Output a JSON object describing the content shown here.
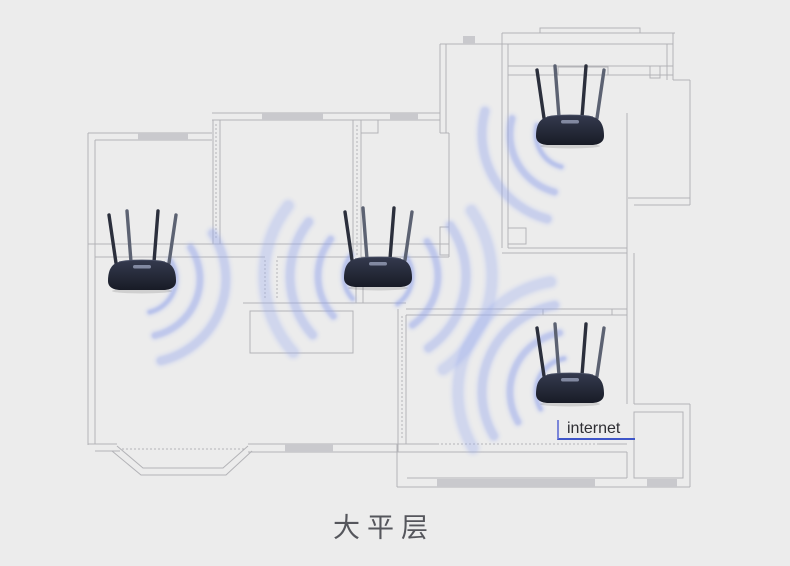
{
  "labels": {
    "internet": "internet",
    "caption": "大平层"
  },
  "colors": {
    "background": "#ececec",
    "wall": "#b3b3b7",
    "window_fill": "#c9c9cd",
    "wifi_wave": "#8c9ee9",
    "wifi_wave_halo": "#bcc6f4",
    "internet_line": "#3e55c8",
    "internet_tick": "#7b86d9",
    "router_body_top": "#343a4e",
    "router_body_bottom": "#181b26",
    "antenna_dark": "#2b2f3c",
    "antenna_light": "#5c6272",
    "caption_text": "#55565c"
  },
  "floorplan": {
    "lines": [
      [
        88,
        133,
        212,
        133
      ],
      [
        95,
        140,
        212,
        140
      ],
      [
        88,
        133,
        88,
        445
      ],
      [
        95,
        140,
        95,
        444
      ],
      [
        213,
        120,
        213,
        244
      ],
      [
        220,
        120,
        220,
        244
      ],
      [
        212,
        113,
        440,
        113
      ],
      [
        212,
        120,
        440,
        120
      ],
      [
        440,
        44,
        440,
        133
      ],
      [
        446,
        44,
        446,
        133
      ],
      [
        440,
        133,
        449,
        133
      ],
      [
        449,
        133,
        449,
        257
      ],
      [
        353,
        120,
        353,
        257
      ],
      [
        361,
        120,
        361,
        257
      ],
      [
        356,
        285,
        356,
        303
      ],
      [
        363,
        285,
        363,
        303
      ],
      [
        88,
        244,
        449,
        244
      ],
      [
        95,
        257,
        265,
        257
      ],
      [
        277,
        257,
        353,
        257
      ],
      [
        361,
        257,
        449,
        257
      ],
      [
        243,
        303,
        406,
        303
      ],
      [
        406,
        309,
        627,
        309
      ],
      [
        406,
        315,
        627,
        315
      ],
      [
        398,
        309,
        398,
        452
      ],
      [
        406,
        315,
        406,
        444
      ],
      [
        88,
        444,
        117,
        444
      ],
      [
        95,
        451,
        120,
        451
      ],
      [
        248,
        444,
        437,
        444
      ],
      [
        597,
        444,
        627,
        444
      ],
      [
        248,
        452,
        627,
        452
      ],
      [
        397,
        444,
        397,
        487
      ],
      [
        397,
        487,
        690,
        487
      ],
      [
        407,
        478,
        627,
        478
      ],
      [
        634,
        478,
        683,
        478
      ],
      [
        627,
        452,
        627,
        478
      ],
      [
        634,
        452,
        634,
        478
      ],
      [
        502,
        33,
        675,
        33
      ],
      [
        440,
        44,
        673,
        44
      ],
      [
        502,
        33,
        502,
        248
      ],
      [
        508,
        44,
        508,
        248
      ],
      [
        673,
        33,
        673,
        80
      ],
      [
        667,
        44,
        667,
        80
      ],
      [
        673,
        80,
        690,
        80
      ],
      [
        690,
        80,
        690,
        205
      ],
      [
        508,
        66,
        673,
        66
      ],
      [
        508,
        75,
        673,
        75
      ],
      [
        627,
        113,
        627,
        404
      ],
      [
        634,
        253,
        634,
        404
      ],
      [
        628,
        198,
        690,
        198
      ],
      [
        634,
        205,
        690,
        205
      ],
      [
        508,
        248,
        627,
        248
      ],
      [
        502,
        253,
        627,
        253
      ],
      [
        634,
        404,
        690,
        404
      ],
      [
        690,
        404,
        690,
        487
      ]
    ],
    "dotted_lines": [
      [
        437,
        444,
        597,
        444
      ],
      [
        122,
        449,
        244,
        449
      ],
      [
        402,
        316,
        402,
        440
      ],
      [
        216,
        124,
        216,
        240
      ],
      [
        357,
        125,
        357,
        255
      ],
      [
        265,
        260,
        265,
        300
      ],
      [
        277,
        260,
        277,
        300
      ]
    ],
    "rects": [
      [
        540,
        28,
        100,
        5
      ],
      [
        558,
        67,
        50,
        8
      ],
      [
        650,
        66,
        10,
        12
      ],
      [
        508,
        228,
        18,
        16
      ],
      [
        250,
        311,
        103,
        42
      ],
      [
        634,
        412,
        49,
        66
      ],
      [
        543,
        309,
        69,
        6
      ],
      [
        440,
        227,
        9,
        28
      ],
      [
        361,
        120,
        17,
        13
      ]
    ],
    "window_fills": [
      [
        138,
        133,
        50,
        7
      ],
      [
        262,
        113,
        61,
        7
      ],
      [
        390,
        113,
        28,
        7
      ],
      [
        463,
        36,
        12,
        8
      ],
      [
        285,
        444,
        48,
        8
      ],
      [
        437,
        479,
        158,
        8
      ],
      [
        647,
        479,
        30,
        8
      ]
    ],
    "bay_window": [
      [
        [
          117,
          446
        ],
        [
          143,
          468
        ],
        [
          223,
          468
        ],
        [
          248,
          446
        ]
      ],
      [
        [
          112,
          451
        ],
        [
          141,
          475
        ],
        [
          226,
          475
        ],
        [
          252,
          451
        ]
      ]
    ]
  },
  "routers": [
    {
      "name": "router-top-right",
      "cx": 570,
      "cy": 130,
      "waves": [
        {
          "dir": 150,
          "spread": 90,
          "radii": [
            34,
            60,
            88
          ]
        }
      ]
    },
    {
      "name": "router-left",
      "cx": 142,
      "cy": 275,
      "waves": [
        {
          "dir": 22,
          "spread": 110,
          "radii": [
            34,
            58,
            84
          ]
        }
      ]
    },
    {
      "name": "router-middle",
      "cx": 378,
      "cy": 272,
      "waves": [
        {
          "dir": 178,
          "spread": 80,
          "radii": [
            34,
            60,
            88,
            114
          ]
        },
        {
          "dir": 10,
          "spread": 90,
          "radii": [
            34,
            60,
            88,
            114
          ]
        }
      ]
    },
    {
      "name": "router-bottom-right",
      "cx": 570,
      "cy": 388,
      "waves": [
        {
          "dir": 205,
          "spread": 110,
          "radii": [
            34,
            60,
            88,
            112
          ]
        }
      ]
    }
  ]
}
